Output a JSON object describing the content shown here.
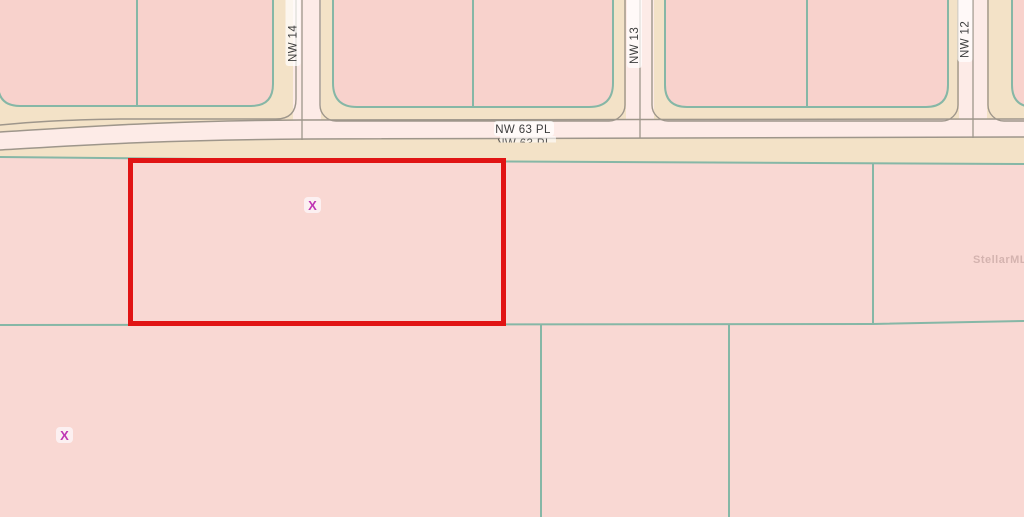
{
  "map": {
    "streets": {
      "horizontal": {
        "label": "NW 63 PL"
      },
      "vertical": [
        {
          "label": "NW 14"
        },
        {
          "label": "NW 13"
        },
        {
          "label": "NW 12"
        }
      ]
    },
    "markers": [
      {
        "glyph": "X"
      },
      {
        "glyph": "X"
      }
    ],
    "watermark": {
      "label": "StellarMLS"
    },
    "colors": {
      "base_pink": "#f9d8d3",
      "parcel_pink": "#f8d2cc",
      "block_beige": "#f3e2c7",
      "road_pink": "#fdebe7",
      "parcel_line": "#86b7a6",
      "road_line": "#9e968b",
      "selection_outline": "#e11414",
      "marker": "#bf36b4",
      "label_text": "#3d3d3d",
      "watermark_text": "#b08f8c"
    }
  }
}
